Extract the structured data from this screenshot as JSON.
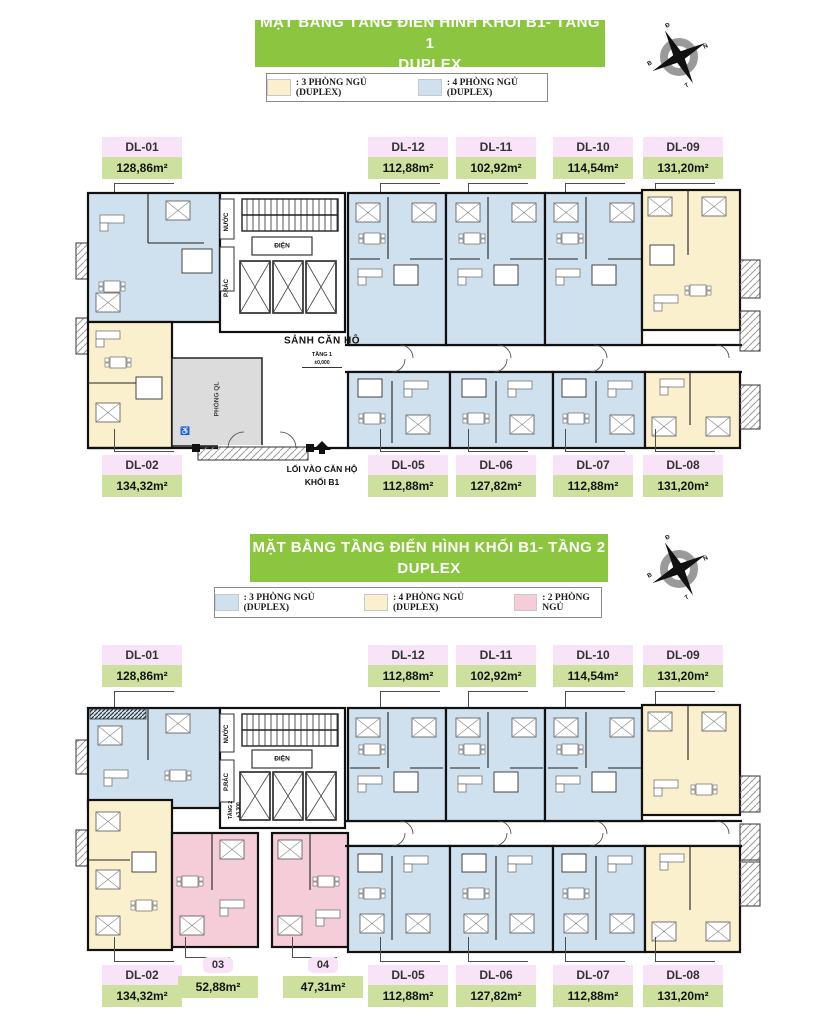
{
  "colors": {
    "header_green": "#8cc540",
    "label_name_bg": "#f8e3f8",
    "label_area_bg": "#cde09e",
    "apartment_blue": "#cfe0ee",
    "apartment_yellow": "#faf0cd",
    "apartment_pink": "#f5cdd9",
    "management_gray": "#dcdcdc"
  },
  "compass": {
    "letters": {
      "top": "Đ",
      "right": "N",
      "bottom": "T",
      "left": "B"
    }
  },
  "icons": {
    "accessibility": "♿"
  },
  "floor1": {
    "title_line1": "MẶT BẰNG TẦNG ĐIỂN HÌNH KHỐI B1- TẦNG 1",
    "title_line2": "DUPLEX",
    "legend": [
      {
        "label": ": 3 PHÒNG NGỦ (DUPLEX)",
        "color": "#faf0cd"
      },
      {
        "label": ": 4 PHÒNG NGỦ (DUPLEX)",
        "color": "#cfe0ee"
      }
    ],
    "units_top": [
      {
        "id": "DL-01",
        "area": "128,86m²"
      },
      {
        "id": "DL-12",
        "area": "112,88m²"
      },
      {
        "id": "DL-11",
        "area": "102,92m²"
      },
      {
        "id": "DL-10",
        "area": "114,54m²"
      },
      {
        "id": "DL-09",
        "area": "131,20m²"
      }
    ],
    "units_bottom": [
      {
        "id": "DL-02",
        "area": "134,32m²"
      },
      {
        "id": "DL-05",
        "area": "112,88m²"
      },
      {
        "id": "DL-06",
        "area": "127,82m²"
      },
      {
        "id": "DL-07",
        "area": "112,88m²"
      },
      {
        "id": "DL-08",
        "area": "131,20m²"
      }
    ],
    "annotations": {
      "lobby": "SẢNH CĂN HỘ",
      "floor_tag": "TẦNG 1",
      "elevation": "±0,000",
      "electric": "ĐIỆN",
      "water": "NƯỚC",
      "trash": "P.RÁC",
      "management": "PHÒNG QL",
      "entry_line1": "LỐI VÀO CĂN HỘ",
      "entry_line2": "KHỐI B1"
    }
  },
  "floor2": {
    "title_line1": "MẶT BẰNG TẦNG ĐIỂN HÌNH KHỐI B1- TẦNG 2",
    "title_line2": "DUPLEX",
    "legend": [
      {
        "label": ": 3 PHÒNG NGỦ (DUPLEX)",
        "color": "#cfe0ee"
      },
      {
        "label": ": 4 PHÒNG NGỦ (DUPLEX)",
        "color": "#faf0cd"
      },
      {
        "label": ": 2 PHÒNG NGỦ",
        "color": "#f5cdd9"
      }
    ],
    "units_top": [
      {
        "id": "DL-01",
        "area": "128,86m²"
      },
      {
        "id": "DL-12",
        "area": "112,88m²"
      },
      {
        "id": "DL-11",
        "area": "102,92m²"
      },
      {
        "id": "DL-10",
        "area": "114,54m²"
      },
      {
        "id": "DL-09",
        "area": "131,20m²"
      }
    ],
    "units_bottom": [
      {
        "id": "DL-02",
        "area": "134,32m²"
      },
      {
        "id": "03",
        "area": "52,88m²"
      },
      {
        "id": "04",
        "area": "47,31m²"
      },
      {
        "id": "DL-05",
        "area": "112,88m²"
      },
      {
        "id": "DL-06",
        "area": "127,82m²"
      },
      {
        "id": "DL-07",
        "area": "112,88m²"
      },
      {
        "id": "DL-08",
        "area": "131,20m²"
      }
    ],
    "annotations": {
      "floor_tag": "TẦNG 2",
      "elevation": "+3,300",
      "electric": "ĐIỆN",
      "water": "NƯỚC",
      "trash": "P.RÁC"
    }
  }
}
